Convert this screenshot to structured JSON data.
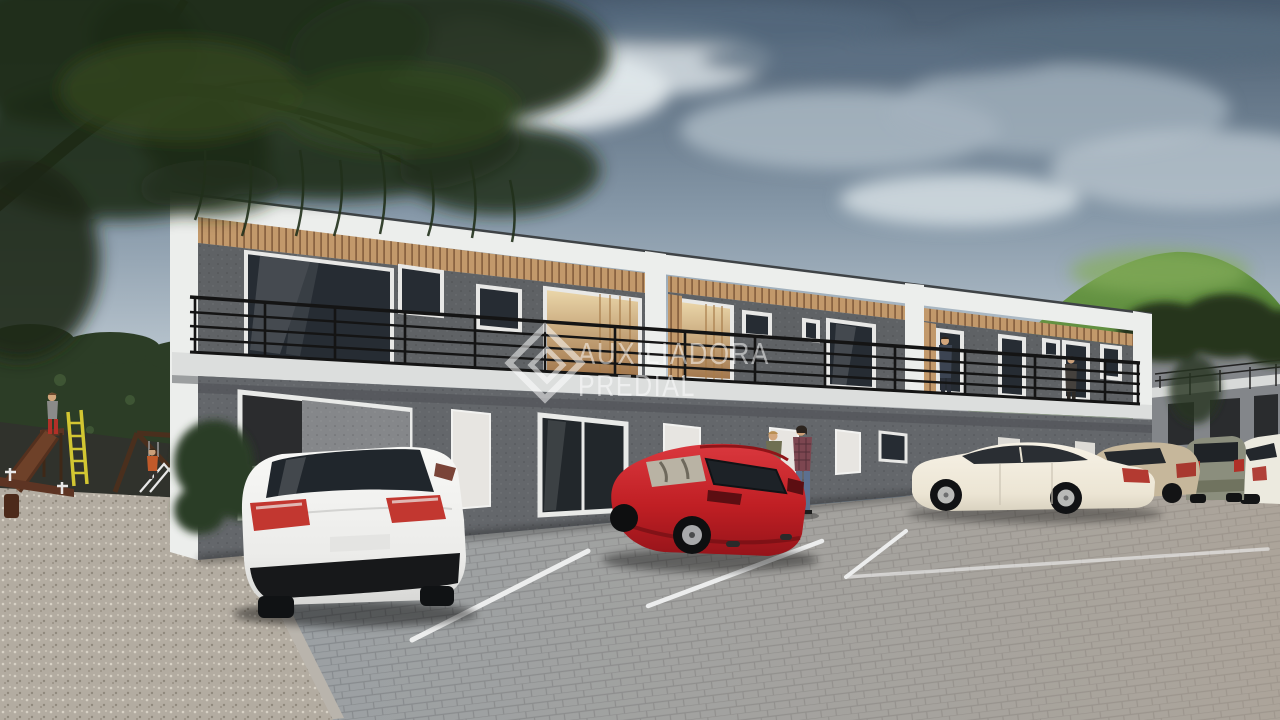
{
  "title": "Two-story residential condominium 3D architectural render with parking lot and playground",
  "watermark": {
    "logo": "auxiliadora-predial-diamond-logo",
    "line1": "AUXILIADORA",
    "line2": "PREDIAL",
    "opacity": "0.52"
  },
  "palette": {
    "sky_top": "#495b6e",
    "sky_light": "#cfd8de",
    "hill_green": "#6f9c4a",
    "hill_dark": "#4a7431",
    "tree_dark": "#1f2b18",
    "building_wall_upper": "#5f6265",
    "building_wall_lower": "#64676b",
    "trim_white": "#eceeec",
    "slab_white": "#dcdedd",
    "wood": "#c2996b",
    "railing_black": "#141414",
    "glass_dark": "#262c33",
    "glass_warm": "#e0bd85",
    "pavement": "#9aa0a4",
    "parking_line": "#eceded",
    "gravel": "#b3aca1",
    "hedge": "#2c3d26",
    "bg_roof_tan": "#cc8c60",
    "car_white": "#f2f2f0",
    "car_red": "#c01f24",
    "car_cream": "#f0ece1",
    "car_beige": "#c6b79b",
    "car_suv_gray": "#8b8e7d",
    "ladder_yellow": "#d2c632",
    "slide_wood": "#6e4129"
  },
  "scene": {
    "sky": "overcast blue-gray sky with clouds",
    "hill": "green hill behind building",
    "tree": "large tree overhanging top-left",
    "building": "two-story gray condo block with white frames, wood soffits and black balcony railings",
    "parking": "paver parking lot with white stall lines",
    "playground": "gravel playground with slide, climbing frame and seesaw",
    "cars": [
      "white sedan rear view",
      "red hatchback",
      "cream sedan side view",
      "beige sedan",
      "gray-green suv",
      "white coupe"
    ],
    "people": [
      "blonde woman walking",
      "woman in plaid walking",
      "man on balcony",
      "woman on balcony",
      "child on slide",
      "child on climber"
    ]
  }
}
